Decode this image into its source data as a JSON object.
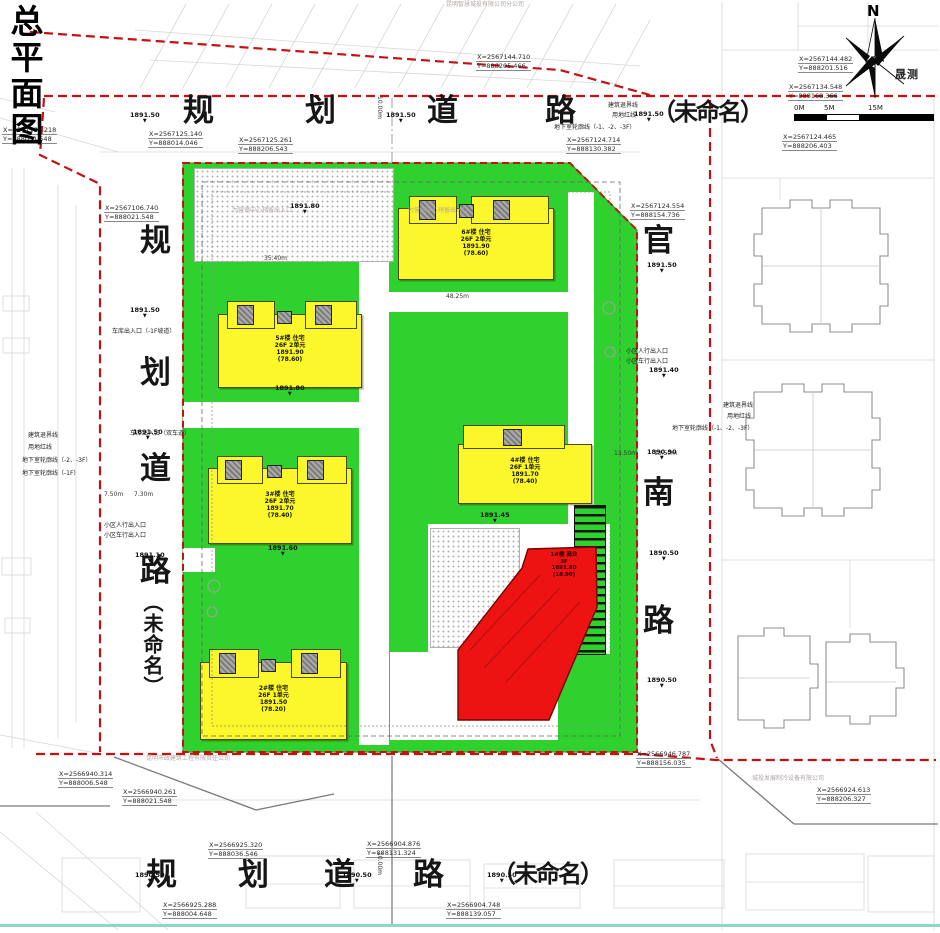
{
  "page": {
    "title": "总平面图"
  },
  "compass": {
    "north": "N",
    "mark": "晟测"
  },
  "scale": {
    "labels": [
      "0M",
      "5M",
      "15M"
    ]
  },
  "roads": {
    "top": "规划道路（未命名）",
    "left": "规划道路（未命名）",
    "right": "官南路",
    "bottom": "规划道路（未命名）"
  },
  "road_chars": [
    {
      "x": 183,
      "y": 96,
      "t": "规"
    },
    {
      "x": 305,
      "y": 96,
      "t": "划"
    },
    {
      "x": 427,
      "y": 96,
      "t": "道"
    },
    {
      "x": 545,
      "y": 96,
      "t": "路"
    },
    {
      "x": 652,
      "y": 100,
      "t": "（未命名）",
      "cls": "rc26"
    },
    {
      "x": 140,
      "y": 226,
      "t": "规"
    },
    {
      "x": 140,
      "y": 358,
      "t": "划"
    },
    {
      "x": 140,
      "y": 454,
      "t": "道"
    },
    {
      "x": 140,
      "y": 556,
      "t": "路"
    },
    {
      "x": 142,
      "y": 592,
      "t": "（未命名）",
      "cls": "vname"
    },
    {
      "x": 643,
      "y": 226,
      "t": "官"
    },
    {
      "x": 643,
      "y": 478,
      "t": "南"
    },
    {
      "x": 643,
      "y": 606,
      "t": "路"
    },
    {
      "x": 146,
      "y": 860,
      "t": "规"
    },
    {
      "x": 238,
      "y": 860,
      "t": "划"
    },
    {
      "x": 324,
      "y": 860,
      "t": "道"
    },
    {
      "x": 413,
      "y": 860,
      "t": "路"
    },
    {
      "x": 492,
      "y": 862,
      "t": "（未命名）",
      "cls": "rc26"
    }
  ],
  "callouts": [
    {
      "x": 2,
      "y": 126,
      "lines": [
        "X=2567135.218",
        "Y=888031.548"
      ]
    },
    {
      "x": 148,
      "y": 130,
      "lines": [
        "X=2567125.140",
        "Y=888014.046"
      ]
    },
    {
      "x": 238,
      "y": 136,
      "lines": [
        "X=2567125.261",
        "Y=888206.543"
      ]
    },
    {
      "x": 476,
      "y": 53,
      "lines": [
        "X=2567144.710",
        "Y=888205.466"
      ]
    },
    {
      "x": 798,
      "y": 55,
      "lines": [
        "X=2567144.482",
        "Y=888201.516"
      ]
    },
    {
      "x": 788,
      "y": 83,
      "lines": [
        "X=2567134.548",
        "Y=888168.366"
      ]
    },
    {
      "x": 566,
      "y": 136,
      "lines": [
        "X=2567124.714",
        "Y=888130.382"
      ]
    },
    {
      "x": 782,
      "y": 133,
      "lines": [
        "X=2567124.465",
        "Y=888206.403"
      ]
    },
    {
      "x": 104,
      "y": 204,
      "lines": [
        "X=2567106.740",
        "Y=888021.548"
      ]
    },
    {
      "x": 630,
      "y": 202,
      "lines": [
        "X=2567124.554",
        "Y=888154.736"
      ]
    },
    {
      "x": 58,
      "y": 770,
      "lines": [
        "X=2566940.314",
        "Y=888006.548"
      ]
    },
    {
      "x": 122,
      "y": 788,
      "lines": [
        "X=2566940.261",
        "Y=888021.548"
      ]
    },
    {
      "x": 636,
      "y": 750,
      "lines": [
        "X=2566946.787",
        "Y=888156.035"
      ]
    },
    {
      "x": 816,
      "y": 786,
      "lines": [
        "X=2566924.613",
        "Y=888206.327"
      ]
    },
    {
      "x": 208,
      "y": 841,
      "lines": [
        "X=2566925.320",
        "Y=888036.546"
      ]
    },
    {
      "x": 366,
      "y": 840,
      "lines": [
        "X=2566904.876",
        "Y=888131.324"
      ]
    },
    {
      "x": 162,
      "y": 901,
      "lines": [
        "X=2566925.288",
        "Y=888004.648"
      ]
    },
    {
      "x": 446,
      "y": 901,
      "lines": [
        "X=2566904.748",
        "Y=888139.057"
      ]
    }
  ],
  "elevations": [
    {
      "x": 130,
      "y": 112,
      "t": "1891.50"
    },
    {
      "x": 386,
      "y": 112,
      "t": "1891.50"
    },
    {
      "x": 634,
      "y": 111,
      "t": "1891.50"
    },
    {
      "x": 130,
      "y": 307,
      "t": "1891.50"
    },
    {
      "x": 133,
      "y": 429,
      "t": "1891.50"
    },
    {
      "x": 135,
      "y": 552,
      "t": "1891.10"
    },
    {
      "x": 647,
      "y": 262,
      "t": "1891.50"
    },
    {
      "x": 649,
      "y": 367,
      "t": "1891.40"
    },
    {
      "x": 647,
      "y": 449,
      "t": "1890.90"
    },
    {
      "x": 649,
      "y": 550,
      "t": "1890.50"
    },
    {
      "x": 647,
      "y": 677,
      "t": "1890.50"
    },
    {
      "x": 135,
      "y": 872,
      "t": "1890.50"
    },
    {
      "x": 342,
      "y": 872,
      "t": "1890.50"
    },
    {
      "x": 487,
      "y": 872,
      "t": "1890.50"
    },
    {
      "x": 290,
      "y": 203,
      "t": "1891.80"
    },
    {
      "x": 275,
      "y": 385,
      "t": "1891.80"
    },
    {
      "x": 268,
      "y": 545,
      "t": "1891.60"
    },
    {
      "x": 480,
      "y": 512,
      "t": "1891.45"
    }
  ],
  "notes": [
    {
      "x": 608,
      "y": 102,
      "t": "建筑退界线"
    },
    {
      "x": 612,
      "y": 112,
      "t": "用地红线"
    },
    {
      "x": 554,
      "y": 124,
      "t": "地下室轮廓线（-1、-2、-3F）"
    },
    {
      "x": 723,
      "y": 402,
      "t": "建筑退界线"
    },
    {
      "x": 727,
      "y": 413,
      "t": "用地红线"
    },
    {
      "x": 672,
      "y": 425,
      "t": "地下室轮廓线（-1、-2、-3F）"
    },
    {
      "x": 28,
      "y": 432,
      "t": "建筑退界线"
    },
    {
      "x": 28,
      "y": 444,
      "t": "用地红线"
    },
    {
      "x": 22,
      "y": 457,
      "t": "地下室轮廓线（-2、-3F）"
    },
    {
      "x": 22,
      "y": 470,
      "t": "地下室轮廓线（-1F）"
    },
    {
      "x": 104,
      "y": 522,
      "t": "小区人行出入口"
    },
    {
      "x": 104,
      "y": 532,
      "t": "小区车行出入口"
    },
    {
      "x": 626,
      "y": 348,
      "t": "小区人行出入口"
    },
    {
      "x": 626,
      "y": 358,
      "t": "小区车行出入口"
    },
    {
      "x": 112,
      "y": 328,
      "t": "车库出入口（-1F坡道）"
    },
    {
      "x": 130,
      "y": 430,
      "t": "车库出入口（双车道）"
    }
  ],
  "dims": [
    {
      "x": 104,
      "y": 492,
      "t": "7.50m"
    },
    {
      "x": 134,
      "y": 492,
      "t": "7.30m"
    },
    {
      "x": 614,
      "y": 451,
      "t": "13.50m"
    },
    {
      "x": 654,
      "y": 451,
      "t": "13.50m"
    },
    {
      "x": 264,
      "y": 256,
      "t": "35.40m"
    },
    {
      "x": 446,
      "y": 294,
      "t": "48.25m"
    },
    {
      "x": 382,
      "y": 96,
      "t": "10.00m",
      "rot": 90
    },
    {
      "x": 382,
      "y": 852,
      "t": "10.00m",
      "rot": 90
    }
  ],
  "wms": [
    {
      "x": 146,
      "y": 756,
      "t": "昆明市政建筑工程有限责任公司"
    },
    {
      "x": 752,
      "y": 776,
      "t": "城投发展制冷设备有限公司"
    },
    {
      "x": 446,
      "y": 2,
      "t": "昆明智慧城投有限公司分公司"
    },
    {
      "x": 232,
      "y": 208,
      "t": "为营销中心预留出入口"
    },
    {
      "x": 408,
      "y": 208,
      "t": "为营销中心预留出入口"
    }
  ],
  "buildings": [
    {
      "id": "6",
      "lines": [
        "6#楼 住宅",
        "26F 2单元",
        "1891.90",
        "(78.60)"
      ]
    },
    {
      "id": "5",
      "lines": [
        "5#楼 住宅",
        "26F 2单元",
        "1891.90",
        "(78.60)"
      ]
    },
    {
      "id": "3",
      "lines": [
        "3#楼 住宅",
        "26F 2单元",
        "1891.70",
        "(78.40)"
      ]
    },
    {
      "id": "2",
      "lines": [
        "2#楼 住宅",
        "26F 1单元",
        "1891.50",
        "(78.20)"
      ]
    },
    {
      "id": "4",
      "lines": [
        "4#楼 住宅",
        "26F 1单元",
        "1891.70",
        "(78.40)"
      ]
    },
    {
      "id": "1",
      "lines": [
        "1#楼 商业",
        "3F",
        "1891.80",
        "(18.90)"
      ]
    }
  ],
  "colors": {
    "site_green": "#2fd12f",
    "building_yellow": "#fcf72a",
    "highlight_red": "#ee1313",
    "redline": "#c41212",
    "teal_border": "#8ed7c6"
  }
}
